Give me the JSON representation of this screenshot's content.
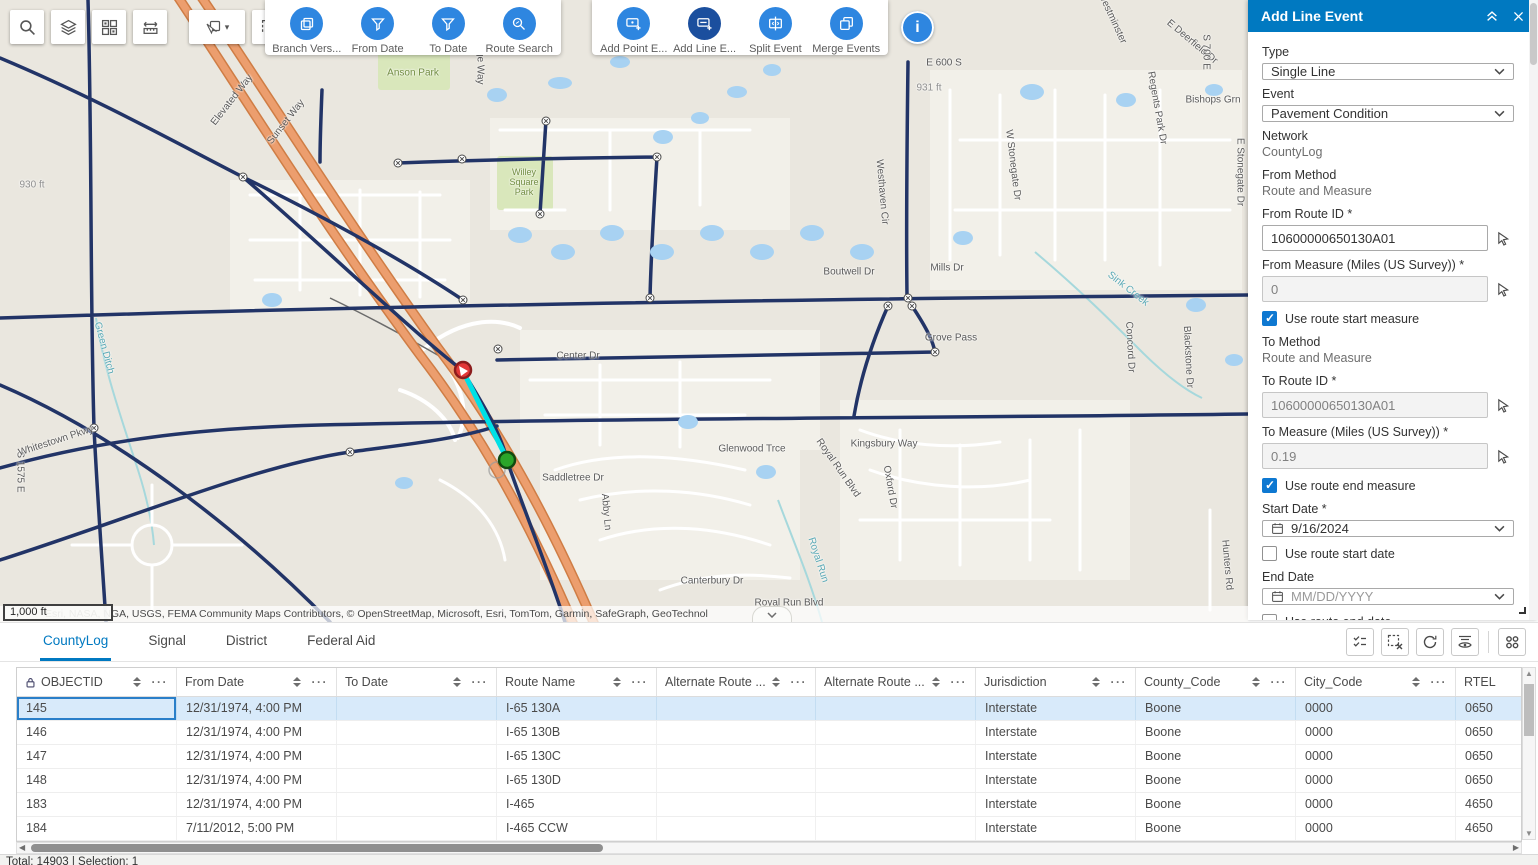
{
  "colors": {
    "panel_header": "#0079c1",
    "accent": "#0079c1",
    "toolbar_icon_circle": "#2e86e0",
    "toolbar_icon_circle_selected": "#1b4f9e",
    "selection_highlight": "#00e0e6",
    "selected_row_bg": "#d8eafa",
    "next_button": "#0e6fd9",
    "highway_orange": "#ec9e6e",
    "route_navy": "#223467"
  },
  "map_toolbar": {
    "buttons": [
      {
        "icon": "search-icon"
      },
      {
        "icon": "layers-icon"
      },
      {
        "icon": "basemap-grid-icon"
      },
      {
        "icon": "measure-icon"
      },
      {
        "icon": "select-icon"
      },
      {
        "icon": "clear-selection-icon"
      },
      {
        "icon": "route-pointer-icon"
      }
    ]
  },
  "event_toolbars": {
    "primary": [
      {
        "label": "Branch Vers...",
        "icon": "branch-versions-icon"
      },
      {
        "label": "From Date",
        "icon": "from-date-filter-icon"
      },
      {
        "label": "To Date",
        "icon": "to-date-filter-icon"
      },
      {
        "label": "Route Search",
        "icon": "route-search-icon"
      }
    ],
    "editing": [
      {
        "label": "Add Point E...",
        "icon": "add-point-event-icon"
      },
      {
        "label": "Add Line E...",
        "icon": "add-line-event-icon",
        "selected": true
      },
      {
        "label": "Split Event",
        "icon": "split-event-icon"
      },
      {
        "label": "Merge Events",
        "icon": "merge-events-icon"
      }
    ]
  },
  "info_button": {
    "icon": "info-icon"
  },
  "map": {
    "scale_label": "1,000 ft",
    "attribution": "Esri, NASA, NGA, USGS, FEMA          Community Maps Contributors, © OpenStreetMap, Microsoft, Esri, TomTom, Garmin, SafeGraph, GeoTechnol",
    "labels": [
      {
        "t": "Elevated Way",
        "x": 232,
        "y": 100,
        "r": -52
      },
      {
        "t": "Sunset Way",
        "x": 286,
        "y": 122,
        "r": -52
      },
      {
        "t": "Anson Park",
        "x": 413,
        "y": 73,
        "c": "#728d43"
      },
      {
        "t": "Willey",
        "x": 524,
        "y": 172,
        "c": "#728d43",
        "s": 9
      },
      {
        "t": "Square",
        "x": 524,
        "y": 182,
        "c": "#728d43",
        "s": 9
      },
      {
        "t": "Park",
        "x": 524,
        "y": 192,
        "c": "#728d43",
        "s": 9
      },
      {
        "t": "Aldridge Way",
        "x": 480,
        "y": 55,
        "r": 90
      },
      {
        "t": "E 600 S",
        "x": 944,
        "y": 63
      },
      {
        "t": "931 ft",
        "x": 929,
        "y": 88,
        "c": "#8f8f8f"
      },
      {
        "t": "930 ft",
        "x": 32,
        "y": 185,
        "c": "#8f8f8f"
      },
      {
        "t": "Mills Dr",
        "x": 947,
        "y": 268
      },
      {
        "t": "Boutwell Dr",
        "x": 849,
        "y": 272
      },
      {
        "t": "Westhaven Cir",
        "x": 882,
        "y": 192,
        "r": 85
      },
      {
        "t": "W Stonegate Dr",
        "x": 1013,
        "y": 165,
        "r": 83
      },
      {
        "t": "Regents Park Dr",
        "x": 1157,
        "y": 108,
        "r": 80
      },
      {
        "t": "Bishops Grn",
        "x": 1213,
        "y": 100
      },
      {
        "t": "E Deerfield Dr",
        "x": 1192,
        "y": 42,
        "r": 40
      },
      {
        "t": "Westminster",
        "x": 1112,
        "y": 18,
        "r": 65
      },
      {
        "t": "S 700 E",
        "x": 1206,
        "y": 52,
        "r": 90
      },
      {
        "t": "E Stonegate Dr",
        "x": 1240,
        "y": 172,
        "r": 90
      },
      {
        "t": "Sink Creek",
        "x": 1128,
        "y": 289,
        "r": 38,
        "c": "#58a8b5"
      },
      {
        "t": "Concord Dr",
        "x": 1130,
        "y": 347,
        "r": 87
      },
      {
        "t": "Blackstone Dr",
        "x": 1188,
        "y": 357,
        "r": 87
      },
      {
        "t": "Grove Pass",
        "x": 951,
        "y": 338
      },
      {
        "t": "Kingsbury Way",
        "x": 884,
        "y": 444
      },
      {
        "t": "Glenwood Trce",
        "x": 752,
        "y": 449
      },
      {
        "t": "Saddletree Dr",
        "x": 573,
        "y": 478
      },
      {
        "t": "Abby Ln",
        "x": 606,
        "y": 512,
        "r": 85
      },
      {
        "t": "Oxford Dr",
        "x": 890,
        "y": 487,
        "r": 80
      },
      {
        "t": "Royal Run Blvd",
        "x": 838,
        "y": 468,
        "r": 55
      },
      {
        "t": "Royal Run Blvd",
        "x": 789,
        "y": 603
      },
      {
        "t": "Royal Run",
        "x": 818,
        "y": 560,
        "r": 72,
        "c": "#58a8b5"
      },
      {
        "t": "Canterbury Dr",
        "x": 712,
        "y": 581
      },
      {
        "t": "Hunters Rd",
        "x": 1227,
        "y": 565,
        "r": 85
      },
      {
        "t": "Center Dr",
        "x": 578,
        "y": 356
      },
      {
        "t": "Green Ditch",
        "x": 104,
        "y": 348,
        "r": 75,
        "c": "#58a8b5"
      },
      {
        "t": "S 1575 E",
        "x": 20,
        "y": 472,
        "r": 90
      },
      {
        "t": "Whitestown Pkwy",
        "x": 56,
        "y": 441,
        "r": -18
      }
    ]
  },
  "panel": {
    "title": "Add Line Event",
    "type_label": "Type",
    "type_value": "Single Line",
    "event_label": "Event",
    "event_value": "Pavement Condition",
    "network_label": "Network",
    "network_value": "CountyLog",
    "from_method_label": "From Method",
    "from_method_value": "Route and Measure",
    "from_route_label": "From Route ID *",
    "from_route_value": "10600000650130A01",
    "from_measure_label": "From Measure (Miles (US Survey)) *",
    "from_measure_value": "0",
    "use_route_start_measure": "Use route start measure",
    "to_method_label": "To Method",
    "to_method_value": "Route and Measure",
    "to_route_label": "To Route ID *",
    "to_route_value": "10600000650130A01",
    "to_measure_label": "To Measure (Miles (US Survey)) *",
    "to_measure_value": "0.19",
    "use_route_end_measure": "Use route end measure",
    "start_date_label": "Start Date *",
    "start_date_value": "9/16/2024",
    "use_route_start_date": "Use route start date",
    "end_date_label": "End Date",
    "end_date_placeholder": "MM/DD/YYYY",
    "use_route_end_date": "Use route end date",
    "reset_label": "Reset",
    "next_label": "Next"
  },
  "tabs": [
    {
      "label": "CountyLog",
      "active": true
    },
    {
      "label": "Signal"
    },
    {
      "label": "District"
    },
    {
      "label": "Federal Aid"
    }
  ],
  "table_toolbar": {
    "icons": [
      "show-selection-icon",
      "clear-selection-icon",
      "refresh-icon",
      "sync-visibility-icon",
      "options-grid-icon"
    ]
  },
  "table": {
    "columns": [
      {
        "label": "OBJECTID",
        "locked": true
      },
      {
        "label": "From Date"
      },
      {
        "label": "To Date"
      },
      {
        "label": "Route Name"
      },
      {
        "label": "Alternate Route ..."
      },
      {
        "label": "Alternate Route ..."
      },
      {
        "label": "Jurisdiction"
      },
      {
        "label": "County_Code"
      },
      {
        "label": "City_Code"
      },
      {
        "label": "RTEL",
        "controls": false
      }
    ],
    "rows": [
      {
        "selected": true,
        "cells": [
          "145",
          "12/31/1974, 4:00 PM",
          "",
          "I-65 130A",
          "",
          "",
          "Interstate",
          "Boone",
          "0000",
          "0650"
        ]
      },
      {
        "cells": [
          "146",
          "12/31/1974, 4:00 PM",
          "",
          "I-65 130B",
          "",
          "",
          "Interstate",
          "Boone",
          "0000",
          "0650"
        ]
      },
      {
        "cells": [
          "147",
          "12/31/1974, 4:00 PM",
          "",
          "I-65 130C",
          "",
          "",
          "Interstate",
          "Boone",
          "0000",
          "0650"
        ]
      },
      {
        "cells": [
          "148",
          "12/31/1974, 4:00 PM",
          "",
          "I-65 130D",
          "",
          "",
          "Interstate",
          "Boone",
          "0000",
          "0650"
        ]
      },
      {
        "cells": [
          "183",
          "12/31/1974, 4:00 PM",
          "",
          "I-465",
          "",
          "",
          "Interstate",
          "Boone",
          "0000",
          "4650"
        ]
      },
      {
        "cells": [
          "184",
          "7/11/2012, 5:00 PM",
          "",
          "I-465 CCW",
          "",
          "",
          "Interstate",
          "Boone",
          "0000",
          "4650"
        ]
      }
    ]
  },
  "status_bar": {
    "total_label": "Total: 14903 | Selection: 1"
  }
}
